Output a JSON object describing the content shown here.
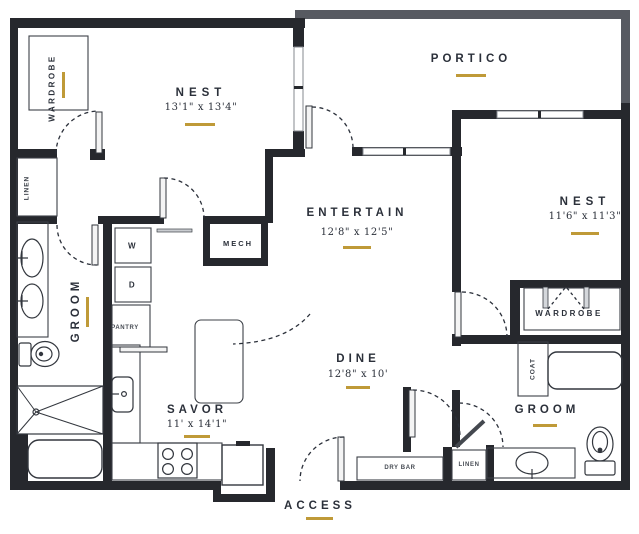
{
  "plan": {
    "rooms": {
      "nest1": {
        "name": "NEST",
        "dims": "13'1\" x 13'4\""
      },
      "nest2": {
        "name": "NEST",
        "dims": "11'6\" x 11'3\""
      },
      "entertain": {
        "name": "ENTERTAIN",
        "dims": "12'8\" x 12'5\""
      },
      "dine": {
        "name": "DINE",
        "dims": "12'8\" x 10'"
      },
      "savor": {
        "name": "SAVOR",
        "dims": "11' x 14'1\""
      },
      "portico": {
        "name": "PORTICO"
      },
      "access": {
        "name": "ACCESS"
      },
      "groom_main": {
        "name": "GROOM"
      },
      "groom_second": {
        "name": "GROOM"
      }
    },
    "closets": {
      "wardrobe_main": "WARDROBE",
      "wardrobe_second": "WARDROBE",
      "linen_main": "LINEN",
      "linen_second": "LINEN",
      "coat": "COAT",
      "pantry": "PANTRY",
      "mech": "MECH",
      "dry_bar": "DRY BAR"
    },
    "appliances": {
      "washer": "W",
      "dryer": "D"
    },
    "colors": {
      "wall": "#26282d",
      "balcony_wall": "#575a61",
      "accent_gold": "#bf9a38",
      "text": "#2b303a"
    }
  }
}
